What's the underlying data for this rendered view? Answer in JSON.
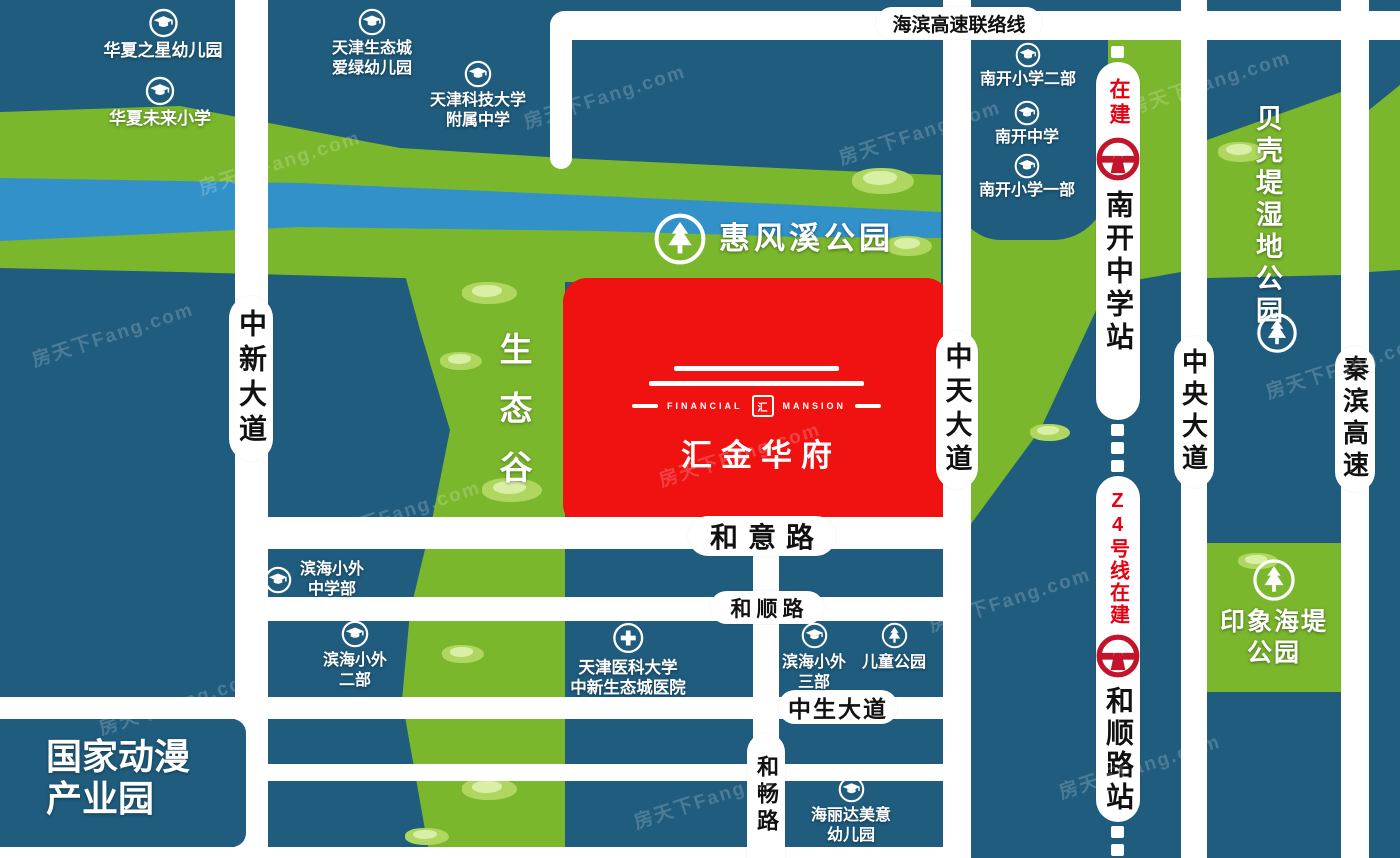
{
  "watermark": "房天下Fang.com",
  "colors": {
    "land": "#1F5C7E",
    "park_green": "#7AB72C",
    "river_blue": "#3191C8",
    "property_red": "#F01111",
    "metro_logo_red": "#C2152B",
    "construction_red": "#E60012",
    "road_white": "#FFFFFF"
  },
  "icons": {
    "school": "graduation-cap-icon",
    "park": "pine-tree-icon",
    "hospital": "medical-cross-icon",
    "metro": "tianjin-metro-logo-icon"
  },
  "property": {
    "name": "汇金华府",
    "en_left": "FINANCIAL",
    "en_right": "MANSION",
    "seal": "汇"
  },
  "roads": {
    "haibin": "海滨高速联络线",
    "zhongxin": "中新大道",
    "zhongtian": "中天大道",
    "zhongyang": "中央大道",
    "qinbin": "秦滨高速",
    "heyi": "和意路",
    "heshun": "和顺路",
    "zhongsheng": "中生大道",
    "hechang": "和畅路"
  },
  "metro": {
    "under_construction": "在建",
    "station_north": "南开中学站",
    "line_label": "Z4号线在建",
    "station_south": "和顺路站"
  },
  "parks": {
    "huifengxi": "惠风溪公园",
    "shengtaigu": "生态谷",
    "beiketi": "贝壳堤湿地公园",
    "yinxiang_line1": "印象海堤",
    "yinxiang_line2": "公园",
    "ertong": "儿童公园"
  },
  "schools": {
    "huaxia_star": "华夏之星幼儿园",
    "huaxia_future": "华夏未来小学",
    "aiyv_line1": "天津生态城",
    "aiyv_line2": "爱绿幼儿园",
    "keji_line1": "天津科技大学",
    "keji_line2": "附属中学",
    "nankai_primary2": "南开小学二部",
    "nankai_middle": "南开中学",
    "nankai_primary1": "南开小学一部",
    "binhai_mid_line1": "滨海小外",
    "binhai_mid_line2": "中学部",
    "binhai2_line1": "滨海小外",
    "binhai2_line2": "二部",
    "binhai3_line1": "滨海小外",
    "binhai3_line2": "三部",
    "hailida_line1": "海丽达美意",
    "hailida_line2": "幼儿园"
  },
  "hospital": {
    "line1": "天津医科大学",
    "line2": "中新生态城医院"
  },
  "landmarks": {
    "anime_line1": "国家动漫",
    "anime_line2": "产业园"
  }
}
